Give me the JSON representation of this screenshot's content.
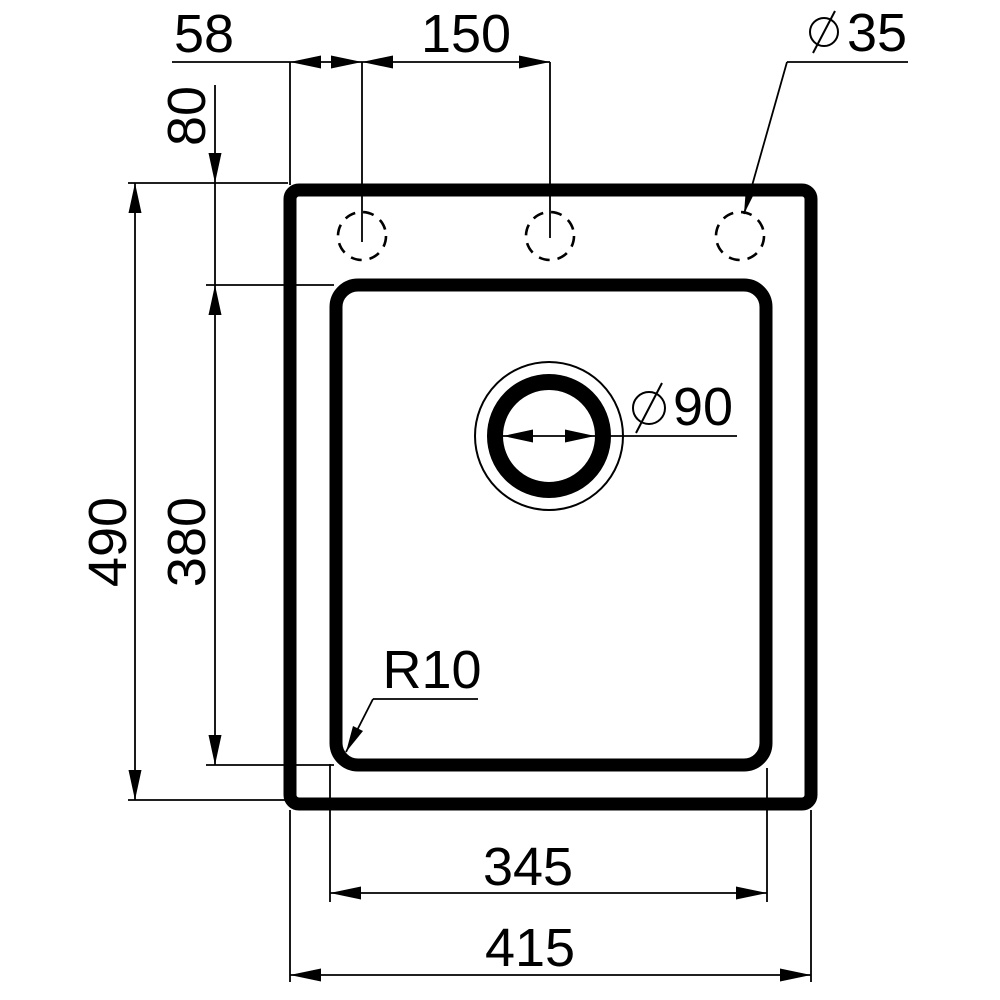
{
  "page": {
    "background": "#ffffff",
    "ink_color": "#000000",
    "drawing_type": "sink-installation-dimension-drawing"
  },
  "labels": {
    "hole_offset_left": "58",
    "hole_pitch": "150",
    "faucet_hole_diameter": "35",
    "top_inset": "80",
    "overall_depth": "490",
    "bowl_depth": "380",
    "drain_diameter": "90",
    "corner_radius": "R10",
    "bowl_width": "345",
    "overall_width": "415"
  },
  "icons": {
    "diameter_symbol": "circle-with-slash"
  }
}
